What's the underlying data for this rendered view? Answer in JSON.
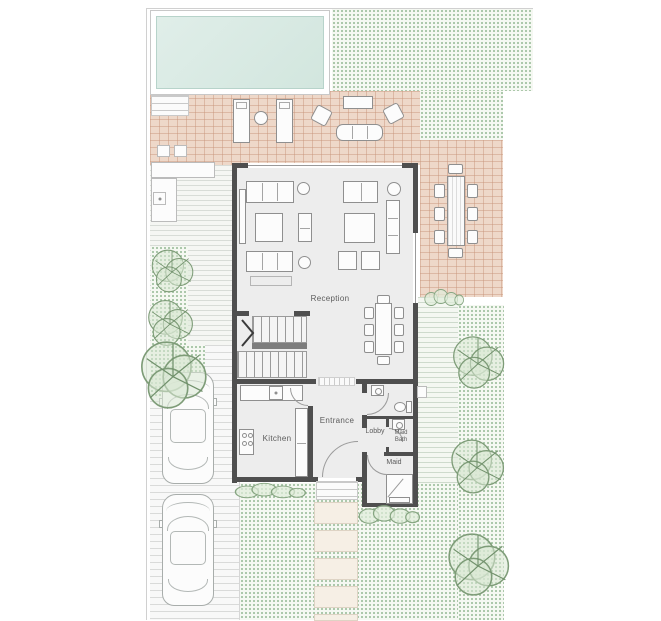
{
  "labels": {
    "reception": "Reception",
    "kitchen": "Kitchen",
    "entrance": "Entrance",
    "lobby": "Lobby",
    "maid_bath_line1": "Maid",
    "maid_bath_line2": "Bath",
    "maid": "Maid"
  },
  "colors": {
    "wall": "#4f4f4f",
    "floor": "#ededed",
    "pool-water": "#d2e6de",
    "water-border": "#b7d3ca",
    "terrace-tile": "#eed8c9",
    "green-dot": "#93b893",
    "green-ground": "#f5f8f2",
    "furniture-line": "#8f8f8f",
    "label-text": "#5c5c5c",
    "stone": "#f6efe5"
  },
  "features": {
    "plan_type": "ground-floor-plan",
    "pool": "swimming-pool",
    "terrace": "tiled-terrace",
    "outdoor_dining_seats": 8,
    "indoor_dining_seats": 8,
    "sun_loungers": 2,
    "cars": 2,
    "trees": 6,
    "stepping_stones": 5,
    "staircase": "u-shaped-stair",
    "bathroom_fixtures": [
      "wash-basin",
      "toilet",
      "wash-basin"
    ]
  }
}
